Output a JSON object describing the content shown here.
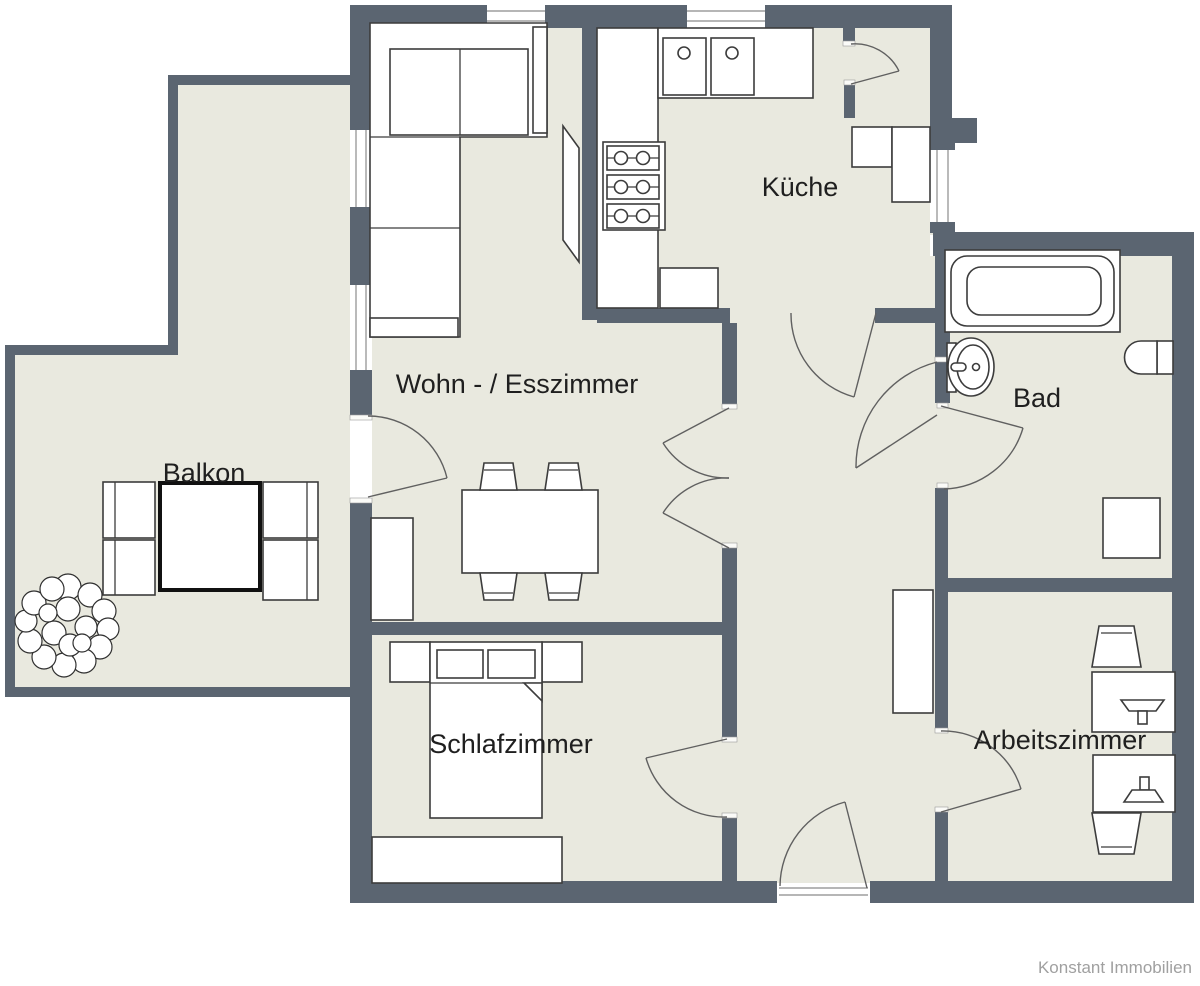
{
  "document": {
    "type": "floor-plan",
    "watermark": "Konstant Immobilien"
  },
  "palette": {
    "wall": "#5b6571",
    "floor": "#e9e9df",
    "furniture_stroke": "#3c3c3c",
    "door_stroke": "#606060",
    "label_color": "#1f1f1f",
    "watermark_color": "#a0a0a0",
    "background": "#ffffff"
  },
  "rooms": [
    {
      "id": "balkon",
      "label": "Balkon"
    },
    {
      "id": "wohn_esszimmer",
      "label": "Wohn - / Esszimmer"
    },
    {
      "id": "kueche",
      "label": "Küche"
    },
    {
      "id": "bad",
      "label": "Bad"
    },
    {
      "id": "schlafzimmer",
      "label": "Schlafzimmer"
    },
    {
      "id": "arbeitszimmer",
      "label": "Arbeitszimmer"
    }
  ],
  "fixtures": [
    "corner-sofa-icon",
    "tv-icon",
    "dining-table-icon",
    "chair-icon",
    "sideboard-icon",
    "kitchen-counter-icon",
    "sink-double-icon",
    "stove-icon",
    "balcony-table-icon",
    "plant-icon",
    "bathtub-icon",
    "washbasin-icon",
    "toilet-icon",
    "double-bed-icon",
    "nightstand-icon",
    "wardrobe-icon",
    "desk-icon",
    "desk-chair-icon",
    "monitor-icon",
    "door-swing-icon",
    "window-icon"
  ]
}
